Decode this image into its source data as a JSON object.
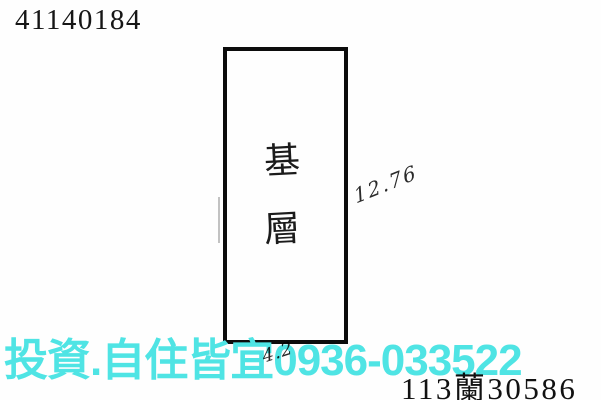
{
  "document": {
    "id_number": "41140184",
    "plan": {
      "label_char_1": "基",
      "label_char_2": "層",
      "side_measurement": "12.76",
      "bottom_measurement": "4.2"
    },
    "reference_number": "113蘭30586"
  },
  "watermark": {
    "text": "投資.自住皆宜0936-033522",
    "color": "#4fe4e4"
  },
  "colors": {
    "background": "#fefefe",
    "ink": "#111111"
  }
}
